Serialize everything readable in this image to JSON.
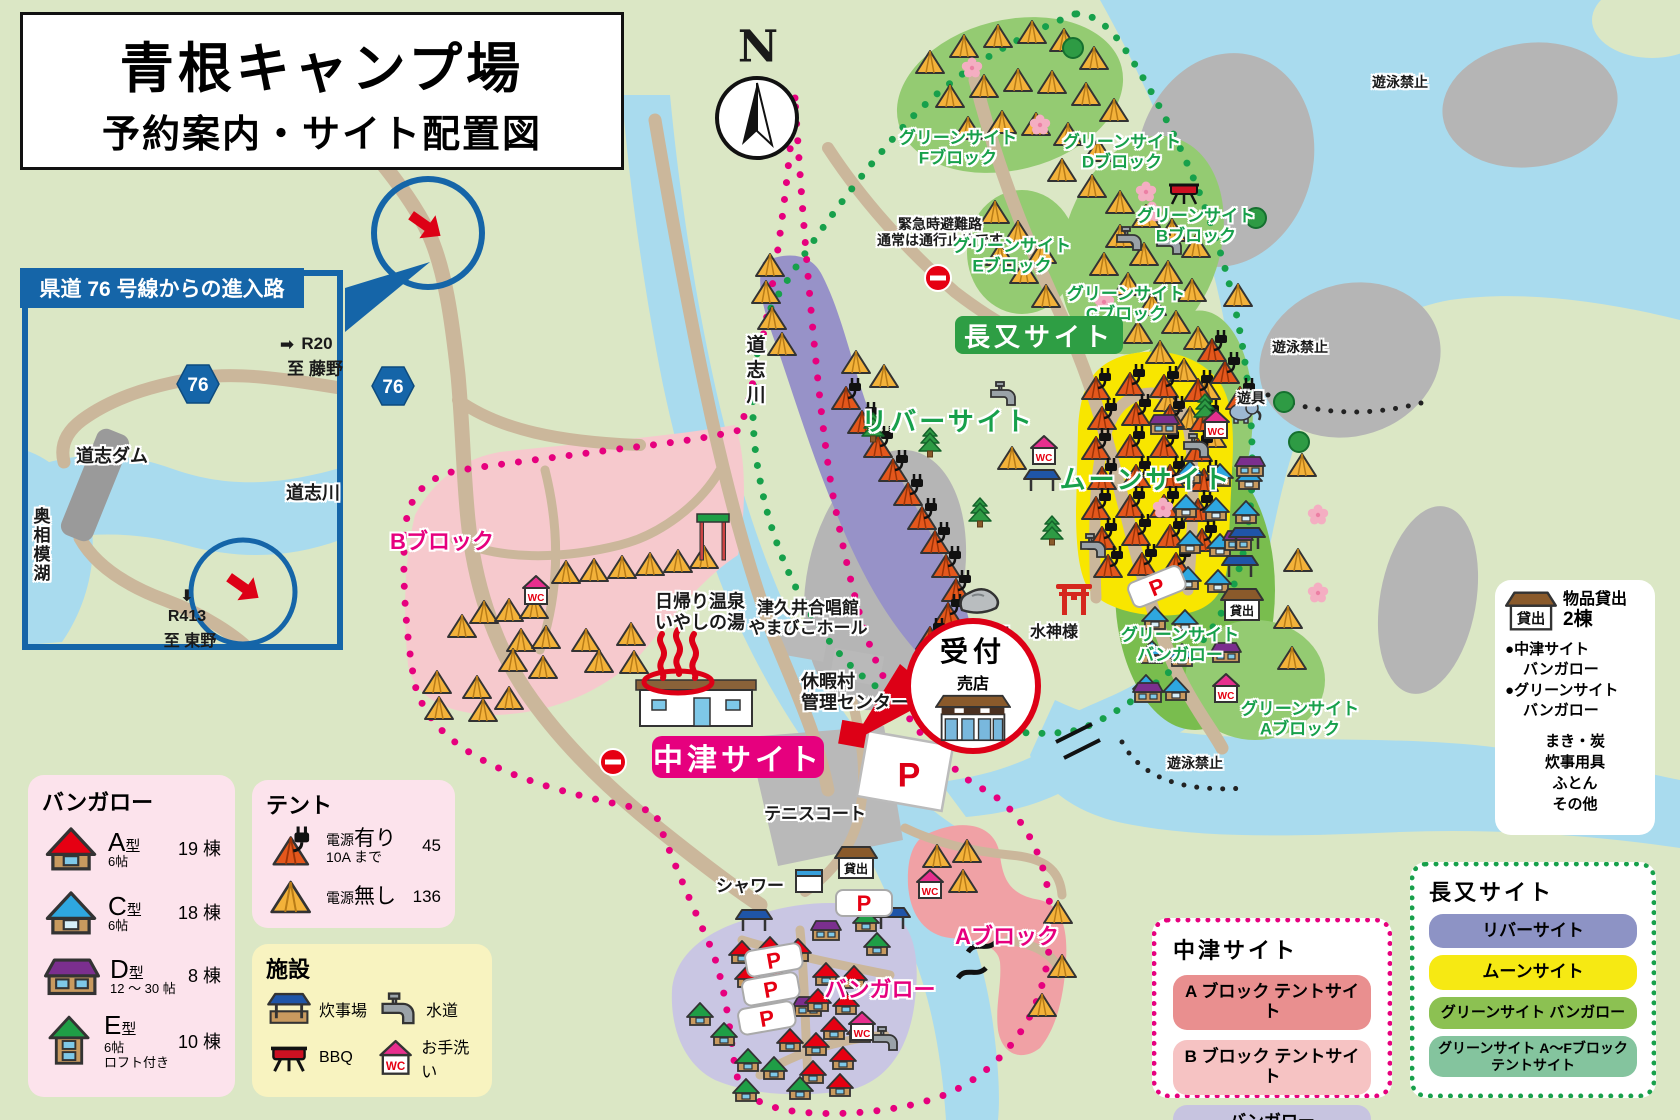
{
  "title": {
    "line1": "青根キャンプ場",
    "line2": "予約案内・サイト配置図"
  },
  "compass": {
    "label": "N"
  },
  "inset": {
    "title": "県道 76 号線からの進入路",
    "route_badge": "76",
    "r20_arrow": "➡",
    "r20": "R20",
    "r20_dest": "至 藤野",
    "dam": "道志ダム",
    "lake": "奥相模湖",
    "river": "道志川",
    "r413_arrow": "⬇",
    "r413": "R413",
    "r413_dest": "至 東野"
  },
  "map": {
    "route_badge": "76",
    "river_label": "道志川",
    "no_swim": "遊泳禁止",
    "emergency1": "緊急時避難路",
    "emergency2": "通常は通行止めです",
    "nagamata_badge": "長又サイト",
    "river_site": "リバーサイト",
    "moon_site": "ムーンサイト",
    "playground": "遊具",
    "water_god": "水神様",
    "monkey_rock": "猿顔石",
    "chorus1": "津久井合唱館",
    "chorus2": "やまびこホール",
    "onsen1": "日帰り温泉",
    "onsen2": "いやしの湯",
    "center1": "休暇村",
    "center2": "管理センター",
    "reception": "受付",
    "shop": "売店",
    "nakatsu_badge": "中津サイト",
    "tennis": "テニスコート",
    "shower": "シャワー",
    "b_block": "Bブロック",
    "a_block": "Aブロック",
    "bungalow": "バンガロー",
    "parking": "P",
    "wc": "WC",
    "rental": "貸出",
    "green_blocks": [
      {
        "line1": "グリーンサイト",
        "line2": "Fブロック"
      },
      {
        "line1": "グリーンサイト",
        "line2": "Dブロック"
      },
      {
        "line1": "グリーンサイト",
        "line2": "Bブロック"
      },
      {
        "line1": "グリーンサイト",
        "line2": "Eブロック"
      },
      {
        "line1": "グリーンサイト",
        "line2": "Cブロック"
      },
      {
        "line1": "グリーンサイト",
        "line2": "Aブロック"
      },
      {
        "line1": "グリーンサイト",
        "line2": "バンガロー"
      }
    ]
  },
  "legend_bungalow": {
    "title": "バンガロー",
    "items": [
      {
        "letter": "A",
        "kei": "型",
        "size": "6帖",
        "size2": "",
        "count": "19 棟",
        "roof": "#e60012"
      },
      {
        "letter": "C",
        "kei": "型",
        "size": "6帖",
        "size2": "",
        "count": "18 棟",
        "roof": "#2ea7e0"
      },
      {
        "letter": "D",
        "kei": "型",
        "size": "12 〜 30 帖",
        "size2": "",
        "count": "8 棟",
        "roof": "#7b2f8e"
      },
      {
        "letter": "E",
        "kei": "型",
        "size": "6帖",
        "size2": "ロフト付き",
        "count": "10 棟",
        "roof": "#1f9e46"
      }
    ]
  },
  "legend_tent": {
    "title": "テント",
    "items": [
      {
        "l1": "電源",
        "l2": "有り",
        "l3": "10A まで",
        "count": "45"
      },
      {
        "l1": "電源",
        "l2": "無し",
        "l3": "",
        "count": "136"
      }
    ]
  },
  "legend_facility": {
    "title": "施設",
    "items": [
      "炊事場",
      "水道",
      "BBQ",
      "お手洗い"
    ]
  },
  "rental_box": {
    "hut": "貸出",
    "title": "物品貸出",
    "count": "2棟",
    "b1l1": "中津サイト",
    "b1l2": "バンガロー",
    "b2l1": "グリーンサイト",
    "b2l2": "バンガロー",
    "items": [
      "まき・炭",
      "炊事用具",
      "ふとん",
      "その他"
    ]
  },
  "legend_nakatsu": {
    "title": "中津サイト",
    "rows": [
      {
        "label": "A ブロック テントサイト",
        "color": "#e98f8f"
      },
      {
        "label": "B ブロック テントサイト",
        "color": "#f6c3c3"
      },
      {
        "label": "バンガロー",
        "color": "#c7c4e0"
      }
    ]
  },
  "legend_nagamata": {
    "title": "長又サイト",
    "rows": [
      {
        "label": "リバーサイト",
        "label2": "",
        "color": "#8d93c5"
      },
      {
        "label": "ムーンサイト",
        "label2": "",
        "color": "#f6e913"
      },
      {
        "label": "グリーンサイト バンガロー",
        "label2": "",
        "color": "#8cc152"
      },
      {
        "label": "グリーンサイト A〜Fブロック",
        "label2": "テントサイト",
        "color": "#84c49e"
      }
    ]
  },
  "colors": {
    "map_bg": "#dbe7c5",
    "water": "#a9dbee",
    "gravel": "#b5b5b5",
    "road": "#cbb79b",
    "nakatsu_pink": "#e6007e",
    "nagamata_green": "#17a04b",
    "moon_yellow": "#f8e600",
    "river_site_purple": "#9792c8",
    "green_site": "#94cb72",
    "inset_blue": "#1565a8",
    "accent_red": "#dd0016"
  }
}
